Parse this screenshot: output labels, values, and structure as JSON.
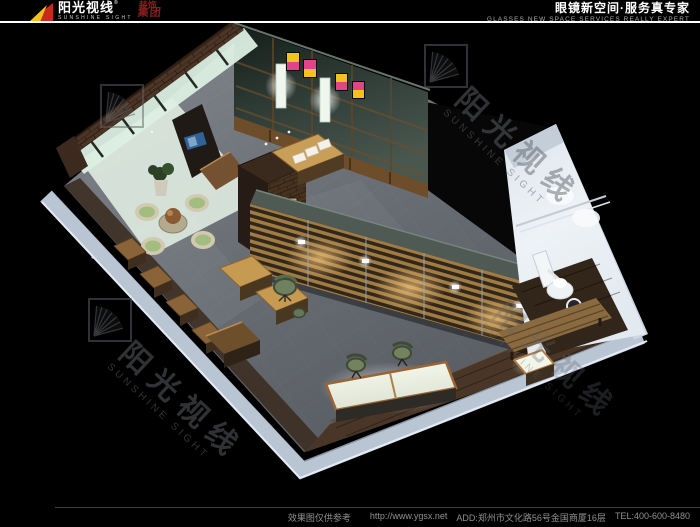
{
  "header": {
    "logo_cn": "阳光视线",
    "logo_reg": "®",
    "logo_en": "SUNSHINE SIGHT",
    "logo_suffix_top": "装饰",
    "logo_suffix_bottom": "集团",
    "tagline_cn": "眼镜新空间·服务真专家",
    "tagline_en": "GLASSES NEW SPACE SERVICES REALLY EXPERT"
  },
  "footer": {
    "disclaimer": "效果图仅供参考",
    "url": "http://www.ygsx.net",
    "address": "ADD:郑州市文化路56号金国商厦16层",
    "tel": "TEL:400-600-8480"
  },
  "watermark": {
    "cn": "阳光视线",
    "en": "SUNSHINE SIGHT"
  },
  "colors": {
    "brand_red": "#8b1d1d",
    "brand_yellow": "#f3c01c",
    "fan_red": "#c8281e",
    "cut_wall_blue": "#bac5d4",
    "teal_wall": "#46544c",
    "wood_accent": "#c59a54",
    "floor_gray": "#6d7277",
    "glass_green": "#dcefe2"
  }
}
